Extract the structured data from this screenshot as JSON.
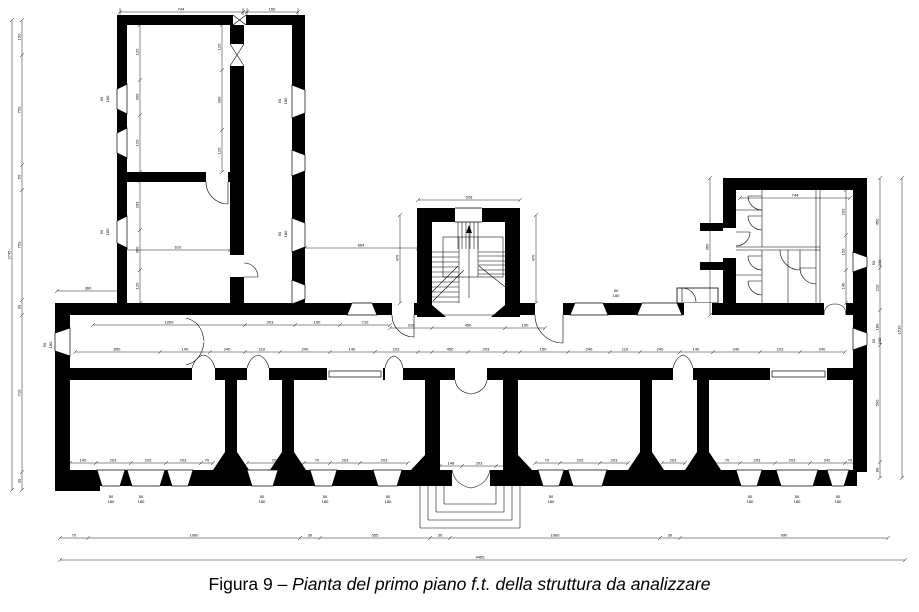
{
  "caption": {
    "prefix": "Figura 9 – ",
    "italic": "Pianta del primo piano f.t. della struttura da analizzare"
  },
  "drawing": {
    "ink": "#000000",
    "background": "#ffffff",
    "dims": [
      {
        "o": "h",
        "c": 12,
        "a": 120,
        "b": 298,
        "ticks": [
          120,
          243,
          247,
          298
        ],
        "labels": [
          [
            181,
            "744"
          ],
          [
            272,
            "150"
          ]
        ]
      },
      {
        "o": "h",
        "c": 200,
        "a": 418,
        "b": 520,
        "ticks": [
          418,
          520
        ],
        "labels": [
          [
            469,
            "528"
          ]
        ]
      },
      {
        "o": "h",
        "c": 198,
        "a": 740,
        "b": 850,
        "ticks": [
          740,
          850
        ],
        "labels": [
          [
            795,
            "744"
          ]
        ]
      },
      {
        "o": "h",
        "c": 248,
        "a": 305,
        "b": 418,
        "ticks": [
          305,
          418
        ],
        "labels": [
          [
            361,
            "664"
          ]
        ]
      },
      {
        "o": "h",
        "c": 250,
        "a": 126,
        "b": 230,
        "ticks": [
          126,
          230
        ],
        "labels": [
          [
            178,
            "610"
          ]
        ]
      },
      {
        "o": "h",
        "c": 291,
        "a": 57,
        "b": 120,
        "ticks": [
          57,
          120
        ],
        "labels": [
          [
            88,
            "360"
          ]
        ]
      },
      {
        "o": "h",
        "c": 325,
        "a": 93,
        "b": 390,
        "ticks": [
          93,
          245,
          295,
          340,
          390
        ],
        "labels": [
          [
            169,
            "1269"
          ],
          [
            270,
            "203"
          ],
          [
            317,
            "150"
          ],
          [
            365,
            "710"
          ]
        ]
      },
      {
        "o": "h",
        "c": 328,
        "a": 390,
        "b": 545,
        "ticks": [
          390,
          432,
          505,
          545
        ],
        "labels": [
          [
            411,
            "318"
          ],
          [
            468,
            "450"
          ],
          [
            525,
            "100"
          ]
        ]
      },
      {
        "o": "h",
        "c": 352,
        "a": 75,
        "b": 845,
        "ticks": [
          75,
          160,
          210,
          245,
          280,
          330,
          375,
          418,
          432,
          468,
          505,
          520,
          568,
          610,
          640,
          680,
          713,
          760,
          800,
          845
        ],
        "labels": [
          [
            117,
            "850"
          ],
          [
            185,
            "140"
          ],
          [
            227,
            "240"
          ],
          [
            262,
            "110"
          ],
          [
            305,
            "240"
          ],
          [
            352,
            "140"
          ],
          [
            396,
            "203"
          ],
          [
            450,
            "450"
          ],
          [
            486,
            "203"
          ],
          [
            543,
            "150"
          ],
          [
            589,
            "240"
          ],
          [
            625,
            "110"
          ],
          [
            660,
            "240"
          ],
          [
            696,
            "140"
          ],
          [
            736,
            "240"
          ],
          [
            780,
            "203"
          ],
          [
            822,
            "240"
          ]
        ]
      },
      {
        "o": "h",
        "c": 463,
        "a": 70,
        "b": 213,
        "ticks": [
          70,
          96,
          131,
          166,
          201,
          213
        ],
        "labels": [
          [
            83,
            "140"
          ],
          [
            113,
            "203"
          ],
          [
            148,
            "203"
          ],
          [
            183,
            "203"
          ],
          [
            207,
            "70"
          ]
        ]
      },
      {
        "o": "h",
        "c": 463,
        "a": 247,
        "b": 304,
        "ticks": [
          247,
          304
        ],
        "labels": [
          [
            275,
            "203"
          ]
        ]
      },
      {
        "o": "h",
        "c": 463,
        "a": 304,
        "b": 408,
        "ticks": [
          304,
          330,
          360,
          408
        ],
        "labels": [
          [
            317,
            "70"
          ],
          [
            345,
            "203"
          ],
          [
            384,
            "203"
          ]
        ]
      },
      {
        "o": "h",
        "c": 466,
        "a": 440,
        "b": 518,
        "ticks": [
          440,
          462,
          496,
          518
        ],
        "labels": [
          [
            451,
            "148"
          ],
          [
            479,
            "203"
          ],
          [
            507,
            "148"
          ]
        ]
      },
      {
        "o": "h",
        "c": 463,
        "a": 535,
        "b": 628,
        "ticks": [
          535,
          560,
          600,
          628
        ],
        "labels": [
          [
            547,
            "70"
          ],
          [
            580,
            "203"
          ],
          [
            614,
            "203"
          ]
        ]
      },
      {
        "o": "h",
        "c": 463,
        "a": 662,
        "b": 685,
        "ticks": [
          662,
          685
        ],
        "labels": [
          [
            673,
            "203"
          ]
        ]
      },
      {
        "o": "h",
        "c": 463,
        "a": 714,
        "b": 855,
        "ticks": [
          714,
          740,
          775,
          810,
          845,
          855
        ],
        "labels": [
          [
            727,
            "70"
          ],
          [
            757,
            "203"
          ],
          [
            792,
            "203"
          ],
          [
            827,
            "242"
          ],
          [
            850,
            "70"
          ]
        ]
      },
      {
        "o": "h",
        "c": 538,
        "a": 60,
        "b": 888,
        "ticks": [
          60,
          88,
          300,
          320,
          430,
          450,
          660,
          680,
          888
        ],
        "labels": [
          [
            74,
            "70"
          ],
          [
            194,
            "1060"
          ],
          [
            310,
            "30"
          ],
          [
            375,
            "555"
          ],
          [
            440,
            "30"
          ],
          [
            555,
            "1060"
          ],
          [
            670,
            "30"
          ],
          [
            784,
            "990"
          ]
        ]
      },
      {
        "o": "h",
        "c": 560,
        "a": 60,
        "b": 905,
        "ticks": [
          60,
          905
        ],
        "labels": [
          [
            480,
            "4465"
          ]
        ]
      },
      {
        "o": "v",
        "c": 22,
        "a": 20,
        "b": 490,
        "ticks": [
          20,
          55,
          165,
          190,
          300,
          315,
          472,
          490
        ],
        "labels": [
          [
            37,
            "150"
          ],
          [
            110,
            "750"
          ],
          [
            177,
            "50"
          ],
          [
            245,
            "750"
          ],
          [
            307,
            "30"
          ],
          [
            393,
            "710"
          ],
          [
            481,
            "30"
          ]
        ]
      },
      {
        "o": "v",
        "c": 12,
        "a": 20,
        "b": 490,
        "ticks": [
          20,
          490
        ],
        "labels": [
          [
            255,
            "2745"
          ]
        ]
      },
      {
        "o": "v",
        "c": 140,
        "a": 25,
        "b": 172,
        "ticks": [
          25,
          80,
          115,
          172
        ],
        "labels": [
          [
            52,
            "120"
          ],
          [
            97,
            "390"
          ],
          [
            143,
            "120"
          ]
        ]
      },
      {
        "o": "v",
        "c": 222,
        "a": 25,
        "b": 172,
        "ticks": [
          25,
          70,
          130,
          172
        ],
        "labels": [
          [
            47,
            "120"
          ],
          [
            100,
            "390"
          ],
          [
            151,
            "120"
          ]
        ]
      },
      {
        "o": "v",
        "c": 140,
        "a": 181,
        "b": 303,
        "ticks": [
          181,
          230,
          270,
          303
        ],
        "labels": [
          [
            205,
            "203"
          ],
          [
            250,
            "390"
          ],
          [
            286,
            "120"
          ]
        ]
      },
      {
        "o": "v",
        "c": 400,
        "a": 215,
        "b": 303,
        "ticks": [
          215,
          303
        ],
        "labels": [
          [
            258,
            "470"
          ]
        ]
      },
      {
        "o": "v",
        "c": 536,
        "a": 215,
        "b": 303,
        "ticks": [
          215,
          303
        ],
        "labels": [
          [
            258,
            "470"
          ]
        ]
      },
      {
        "o": "v",
        "c": 710,
        "a": 178,
        "b": 315,
        "ticks": [
          178,
          315
        ],
        "labels": [
          [
            247,
            "360"
          ]
        ]
      },
      {
        "o": "v",
        "c": 846,
        "a": 190,
        "b": 303,
        "ticks": [
          190,
          235,
          270,
          303
        ],
        "labels": [
          [
            212,
            "203"
          ],
          [
            252,
            "150"
          ],
          [
            286,
            "140"
          ]
        ]
      },
      {
        "o": "v",
        "c": 880,
        "a": 178,
        "b": 478,
        "ticks": [
          178,
          268,
          310,
          345,
          462,
          478
        ],
        "labels": [
          [
            222,
            "450"
          ],
          [
            288,
            "210"
          ],
          [
            327,
            "180"
          ],
          [
            403,
            "590"
          ],
          [
            470,
            "80"
          ]
        ]
      },
      {
        "o": "v",
        "c": 902,
        "a": 178,
        "b": 478,
        "ticks": [
          178,
          478
        ],
        "labels": [
          [
            330,
            "1510"
          ]
        ]
      }
    ],
    "windows": [
      [
        97,
        470,
        28,
        "B",
        16
      ],
      [
        127,
        470,
        38,
        "B",
        16
      ],
      [
        167,
        470,
        26,
        "B",
        16
      ],
      [
        247,
        470,
        31,
        "B",
        16
      ],
      [
        310,
        470,
        27,
        "B",
        16
      ],
      [
        373,
        470,
        29,
        "B",
        16
      ],
      [
        538,
        470,
        26,
        "B",
        16
      ],
      [
        568,
        470,
        39,
        "B",
        16
      ],
      [
        736,
        470,
        26,
        "B",
        16
      ],
      [
        776,
        470,
        42,
        "B",
        16
      ],
      [
        827,
        470,
        22,
        "B",
        16
      ],
      [
        347,
        303,
        30,
        "T",
        12
      ],
      [
        570,
        303,
        38,
        "T",
        12
      ],
      [
        637,
        303,
        45,
        "T",
        12
      ],
      [
        117,
        84,
        30,
        "L",
        10
      ],
      [
        117,
        128,
        30,
        "L",
        10
      ],
      [
        117,
        216,
        32,
        "L",
        10
      ],
      [
        55,
        328,
        28,
        "L",
        15
      ],
      [
        292,
        85,
        33,
        "R",
        13
      ],
      [
        292,
        150,
        26,
        "R",
        13
      ],
      [
        292,
        218,
        34,
        "R",
        13
      ],
      [
        292,
        280,
        24,
        "R",
        13
      ],
      [
        853,
        252,
        20,
        "R",
        14
      ],
      [
        853,
        328,
        22,
        "R",
        14
      ],
      [
        327,
        368,
        56,
        "F",
        12
      ],
      [
        770,
        368,
        57,
        "F",
        12
      ]
    ],
    "doors": [
      {
        "gap": [
          192,
          368,
          23,
          12
        ],
        "d": "M192,368 Q195,357 203.5,355 Q212,357 215,368"
      },
      {
        "gap": [
          247,
          368,
          22,
          12
        ],
        "d": "M247,368 Q250,357 258,355 Q266,357 269,368"
      },
      {
        "gap": [
          385,
          368,
          18,
          12
        ],
        "d": "M385,368 Q387,358 394,356 Q401,358 403,368"
      },
      {
        "gap": [
          673,
          368,
          20,
          12
        ],
        "d": "M673,368 Q676,357 683,355 Q690,357 693,368"
      },
      {
        "gap": [
          455,
          368,
          32,
          12
        ],
        "d": "M455,380 Q457,392 471,394 Q485,392 487,380"
      },
      {
        "gap": [
          452,
          470,
          38,
          16
        ],
        "d": "M452,470 Q455,485 471,488 Q487,485 490,470"
      },
      {
        "d": "M186,318 Q202,322 204,341 M186,365 Q202,361 204,342"
      },
      {
        "gap": [
          535,
          303,
          28,
          12
        ],
        "d": "M563,315 L563,343 M535,315 A28 28 0 0 0 563,343"
      },
      {
        "gap": [
          824,
          303,
          22,
          12
        ],
        "d": "M824,315 Q824,304 835,304 Q846,304 846,315"
      },
      {
        "gap": [
          684,
          303,
          28,
          12
        ],
        "d": "M682,302 L682,288 A14 14 0 0 1 696,302"
      },
      {
        "gap": [
          233,
          15,
          13,
          10
        ],
        "d": "M233,15 L246,25 M246,15 L233,25"
      },
      {
        "gap": [
          230,
          44,
          14,
          22
        ],
        "d": "M230,44 L244,66 M244,44 L230,66"
      },
      {
        "gap": [
          230,
          255,
          14,
          22
        ],
        "d": "M244,277 L258,277 M244,263 A14 14 0 0 1 258,277"
      },
      {
        "gap": [
          206,
          172,
          22,
          10
        ],
        "d": "M228,182 L228,204 M206,182 A22 22 0 0 0 228,204"
      },
      {
        "gap": [
          392,
          303,
          22,
          12
        ],
        "d": "M414,315 L414,337 M392,315 A22 22 0 0 0 414,337"
      },
      {
        "d": "M762,196 L748,196 M762,210 A14 14 0 0 1 748,196"
      },
      {
        "d": "M762,216 L748,216 M762,230 A14 14 0 0 1 748,216"
      },
      {
        "d": "M762,256 L748,256 M762,270 A14 14 0 0 1 748,256"
      },
      {
        "d": "M762,281 L748,281 M762,295 A14 14 0 0 1 748,281"
      },
      {
        "d": "M800,250 L800,270 M780,250 A20 20 0 0 0 800,270"
      },
      {
        "d": "M816,268 L800,268 M816,284 A16 16 0 0 1 800,268"
      },
      {
        "gap": [
          723,
          228,
          13,
          30
        ],
        "d": "M736,232 L750,232 M736,246 A14 14 0 0 0 750,232"
      }
    ],
    "texts": [
      [
        111,
        498,
        "50"
      ],
      [
        111,
        503,
        "180"
      ],
      [
        141,
        498,
        "50"
      ],
      [
        141,
        503,
        "180"
      ],
      [
        262,
        498,
        "50"
      ],
      [
        262,
        503,
        "180"
      ],
      [
        325,
        498,
        "50"
      ],
      [
        325,
        503,
        "180"
      ],
      [
        388,
        498,
        "50"
      ],
      [
        388,
        503,
        "180"
      ],
      [
        551,
        498,
        "50"
      ],
      [
        551,
        503,
        "180"
      ],
      [
        750,
        498,
        "50"
      ],
      [
        750,
        503,
        "180"
      ],
      [
        797,
        498,
        "50"
      ],
      [
        797,
        503,
        "180"
      ],
      [
        838,
        498,
        "50"
      ],
      [
        838,
        503,
        "180"
      ],
      [
        46,
        345,
        "50",
        1
      ],
      [
        52,
        345,
        "180",
        1
      ],
      [
        103,
        99,
        "50",
        1
      ],
      [
        109,
        99,
        "180",
        1
      ],
      [
        103,
        232,
        "50",
        1
      ],
      [
        109,
        232,
        "180",
        1
      ],
      [
        281,
        101,
        "50",
        1
      ],
      [
        287,
        101,
        "180",
        1
      ],
      [
        281,
        234,
        "50",
        1
      ],
      [
        287,
        234,
        "180",
        1
      ],
      [
        875,
        263,
        "50",
        1
      ],
      [
        881,
        263,
        "240",
        1
      ],
      [
        875,
        341,
        "50",
        1
      ],
      [
        881,
        341,
        "240",
        1
      ],
      [
        616,
        292,
        "50"
      ],
      [
        616,
        297,
        "180"
      ]
    ]
  }
}
